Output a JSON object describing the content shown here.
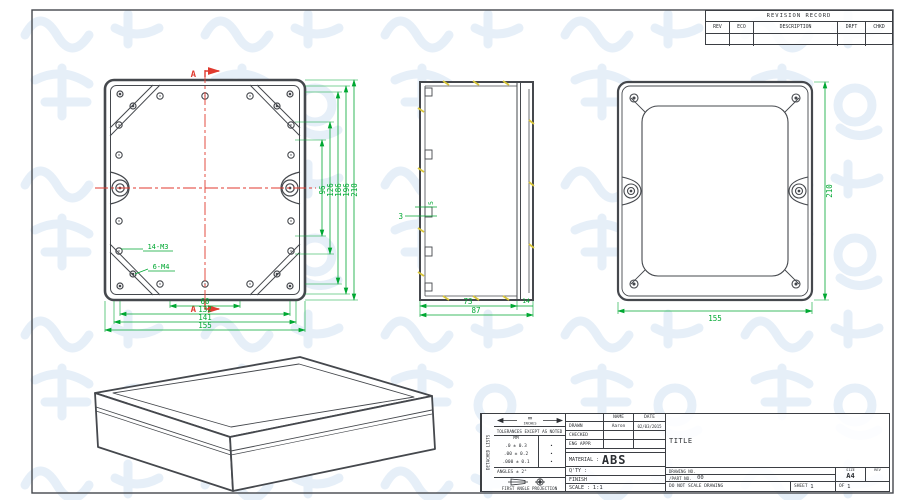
{
  "colors": {
    "line": "#45484d",
    "dimension": "#00a832",
    "centerline": "#e03a2f",
    "hidden_tick": "#d9c63a",
    "watermark": "#dde9f6"
  },
  "revision_table": {
    "title": "REVISION RECORD",
    "columns": [
      "REV",
      "ECO",
      "DESCRIPTION",
      "DRFT",
      "CHKD"
    ]
  },
  "front_view": {
    "section_label": "A",
    "label_m3": "14-M3",
    "label_m4": "6-M4",
    "dims_vertical": [
      "96",
      "126",
      "186",
      "196",
      "210"
    ],
    "dims_horizontal": [
      "60",
      "132",
      "141",
      "155"
    ]
  },
  "side_view": {
    "dim_rib": "3",
    "dim_boss": "5",
    "dim_body": "73",
    "dim_lid": "14",
    "dim_total": "87"
  },
  "back_view": {
    "dim_height": "210",
    "dim_width": "155"
  },
  "title_block": {
    "side_strip": "DETACHED LISTS",
    "units_primary": "MM",
    "units_secondary": "INCHES",
    "tolerances_heading": "TOLERANCES EXCEPT AS NOTED",
    "tol_unit": "MM",
    "tol_rows": [
      ".0 ± 0.3",
      ".00 ± 0.2",
      ".000 ± 0.1"
    ],
    "tol_marks": [
      "•",
      "•",
      "•"
    ],
    "angles": "ANGLES ± 2°",
    "projection": "FIRST ANGLE PROJECTION",
    "name_header": "NAME",
    "date_header": "DATE",
    "rows": [
      {
        "label": "DRAWN",
        "name": "Aaron",
        "date": "02/03/2015"
      },
      {
        "label": "CHECKED",
        "name": "",
        "date": ""
      },
      {
        "label": "ENG APPR",
        "name": "",
        "date": ""
      }
    ],
    "material_label": "MATERIAL :",
    "material_value": "ABS",
    "qty_label": "Q'TY :",
    "finish_label": "FINISH",
    "scale_label": "SCALE :",
    "scale_value": "1:1",
    "title_label": "TITLE",
    "drawing_no_label": "DRAWING NO.",
    "part_no_label": "/PART NO.",
    "part_no_value": "00",
    "size_label": "SIZE",
    "size_value": "A4",
    "rev_label": "REV",
    "do_not_scale": "DO NOT SCALE DRAWING",
    "sheet_label": "SHEET",
    "sheet_value": "1",
    "of_label": "OF",
    "of_value": "1"
  }
}
